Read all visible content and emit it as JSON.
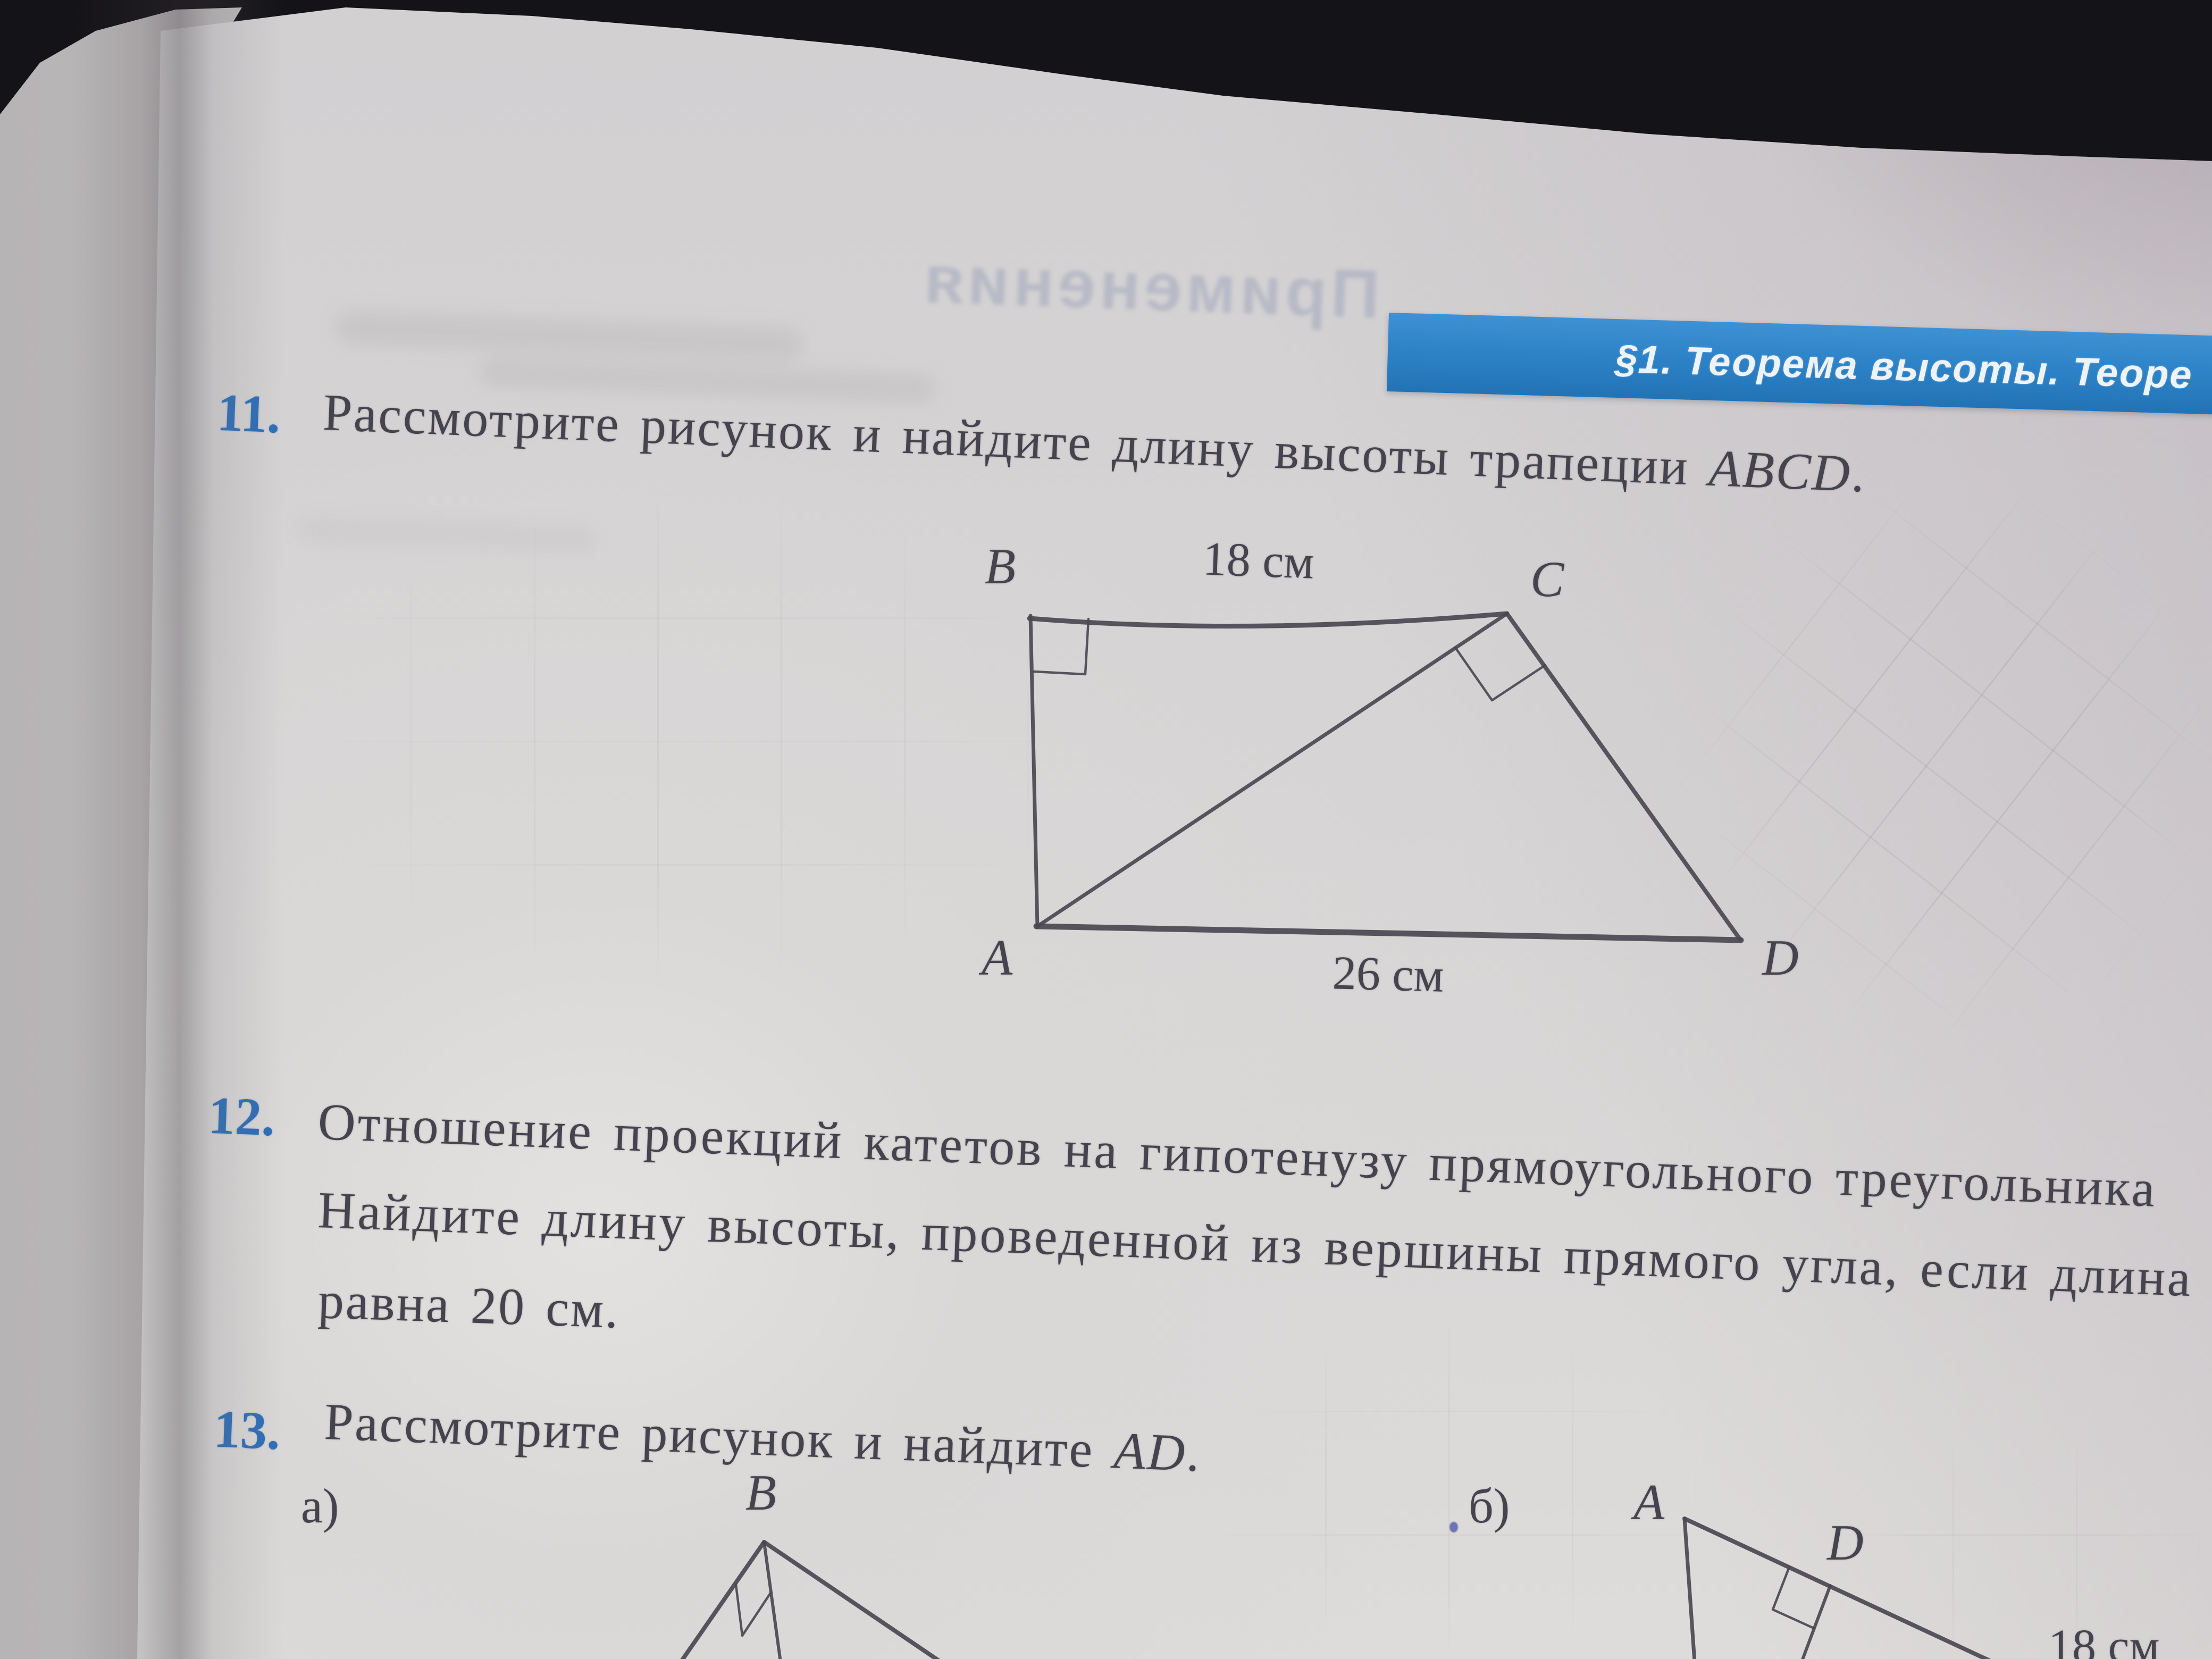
{
  "banner": {
    "text": "§1. Теорема высоты. Теоре",
    "bg_color": "#2e83c8",
    "text_color": "#eef3f8"
  },
  "show_through": {
    "mirrored_header": "Применения"
  },
  "problems": {
    "p11": {
      "number": "11.",
      "text": "Рассмотрите рисунок и найдите длину высоты трапеции ",
      "math": "ABCD",
      "tail": "."
    },
    "p12": {
      "number": "12.",
      "line1": "Отношение проекций катетов на гипотенузу прямоугольного треугольника",
      "line2": "Найдите длину высоты, проведенной из вершины прямого угла, если длина",
      "line3": "равна 20 см."
    },
    "p13": {
      "number": "13.",
      "text": "Рассмотрите рисунок и найдите ",
      "math": "AD",
      "tail": "."
    }
  },
  "trapezoid_figure": {
    "vertex_b": "B",
    "vertex_c": "C",
    "vertex_a": "A",
    "vertex_d": "D",
    "top_length": "18 см",
    "bottom_length": "26 см"
  },
  "figure_a": {
    "item_label": "а)",
    "vertex_b": "B"
  },
  "figure_b": {
    "item_label": "б)",
    "vertex_a": "A",
    "vertex_d": "D",
    "length": "18 см"
  },
  "accent_colors": {
    "problem_number_blue": "#2f6fb8",
    "ink": "#45434d",
    "paper": "#d9d7d6"
  }
}
